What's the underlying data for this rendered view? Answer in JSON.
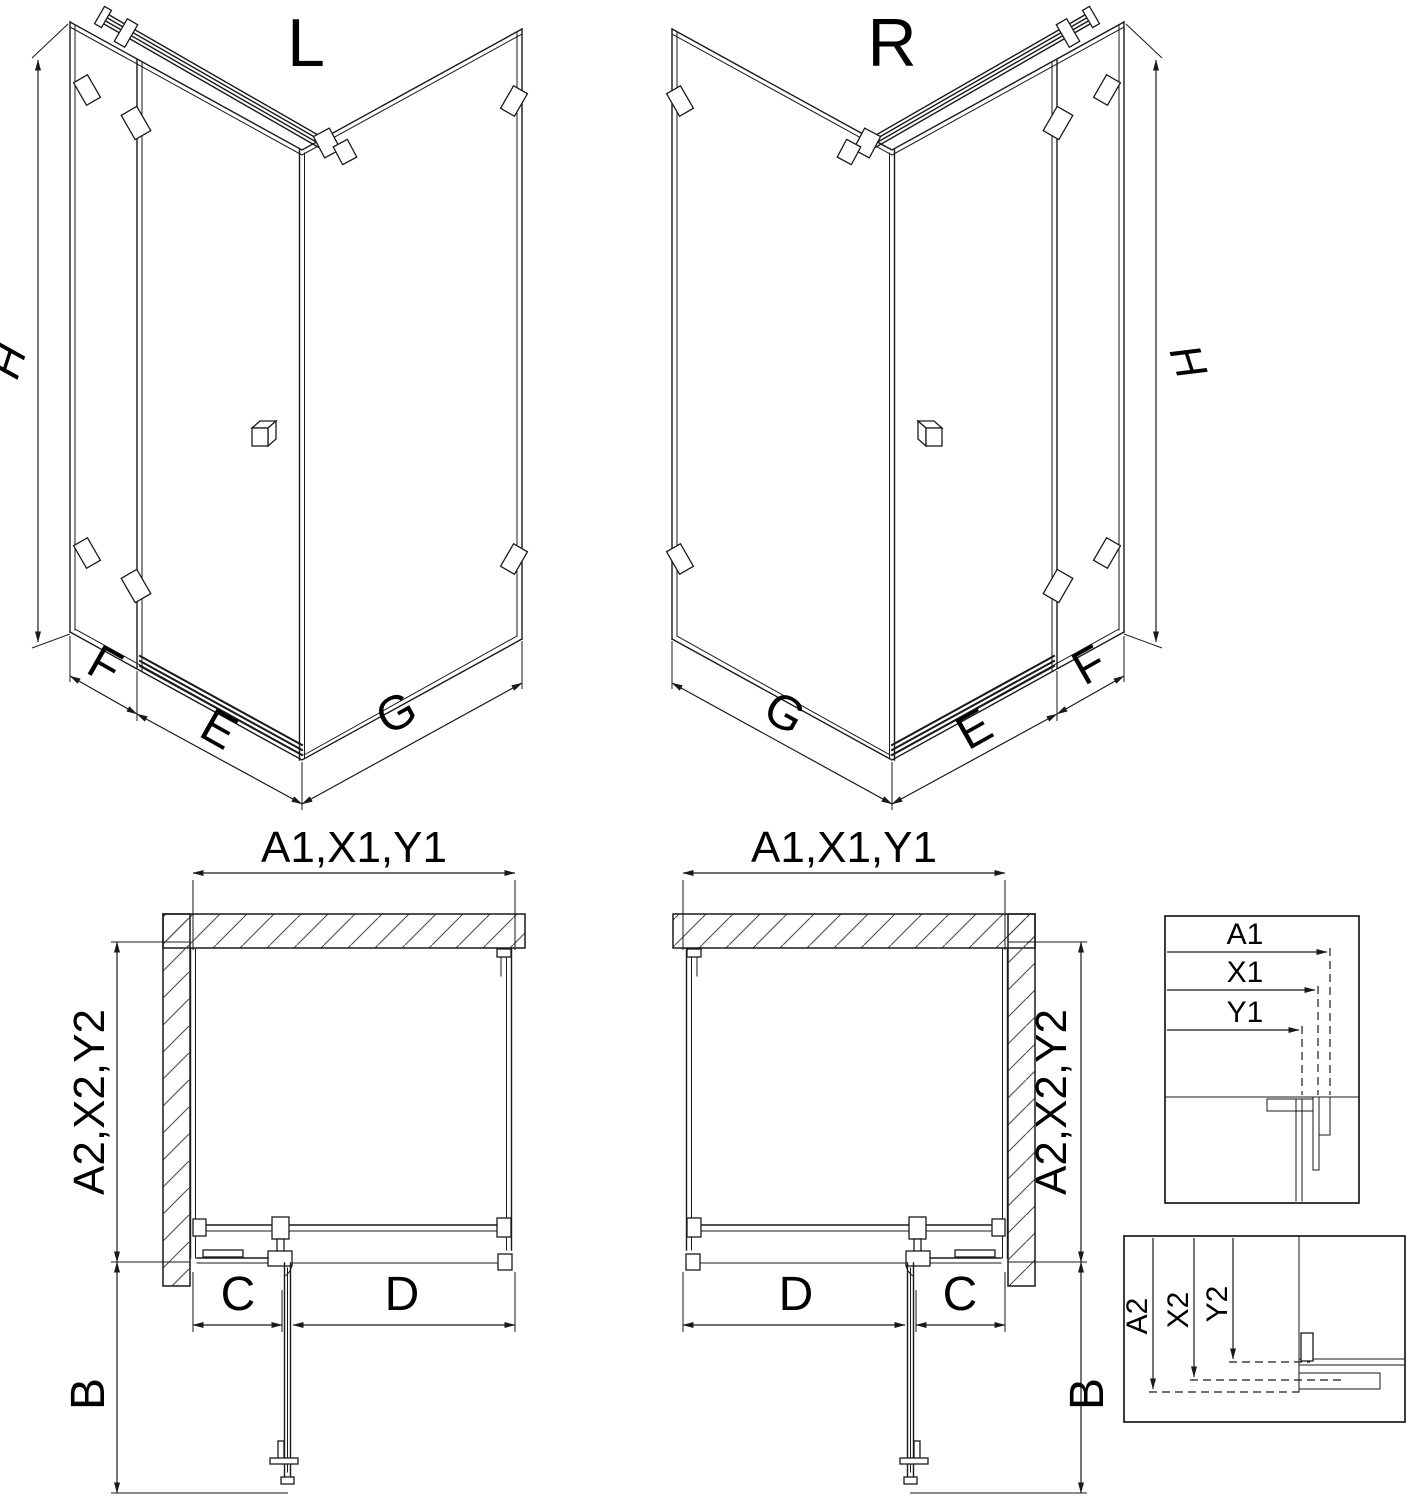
{
  "diagram": {
    "iso_left": {
      "variant": "L",
      "height": "H",
      "side_depth": "F",
      "front_width": "E",
      "return_width": "G"
    },
    "iso_right": {
      "variant": "R",
      "height": "H",
      "side_depth": "F",
      "front_width": "E",
      "return_width": "G"
    },
    "plan_left": {
      "overall_width": "A1,X1,Y1",
      "overall_depth": "A2,X2,Y2",
      "door_swing": "B",
      "fixed_panel": "C",
      "door_width": "D"
    },
    "plan_right": {
      "overall_width": "A1,X1,Y1",
      "overall_depth": "A2,X2,Y2",
      "door_swing": "B",
      "fixed_panel": "C",
      "door_width": "D"
    },
    "detail_width": {
      "a": "A1",
      "x": "X1",
      "y": "Y1"
    },
    "detail_depth": {
      "a": "A2",
      "x": "X2",
      "y": "Y2"
    },
    "colors": {
      "line": "#1a1a1a",
      "hatch": "#4d4d4d",
      "background": "#ffffff"
    }
  }
}
